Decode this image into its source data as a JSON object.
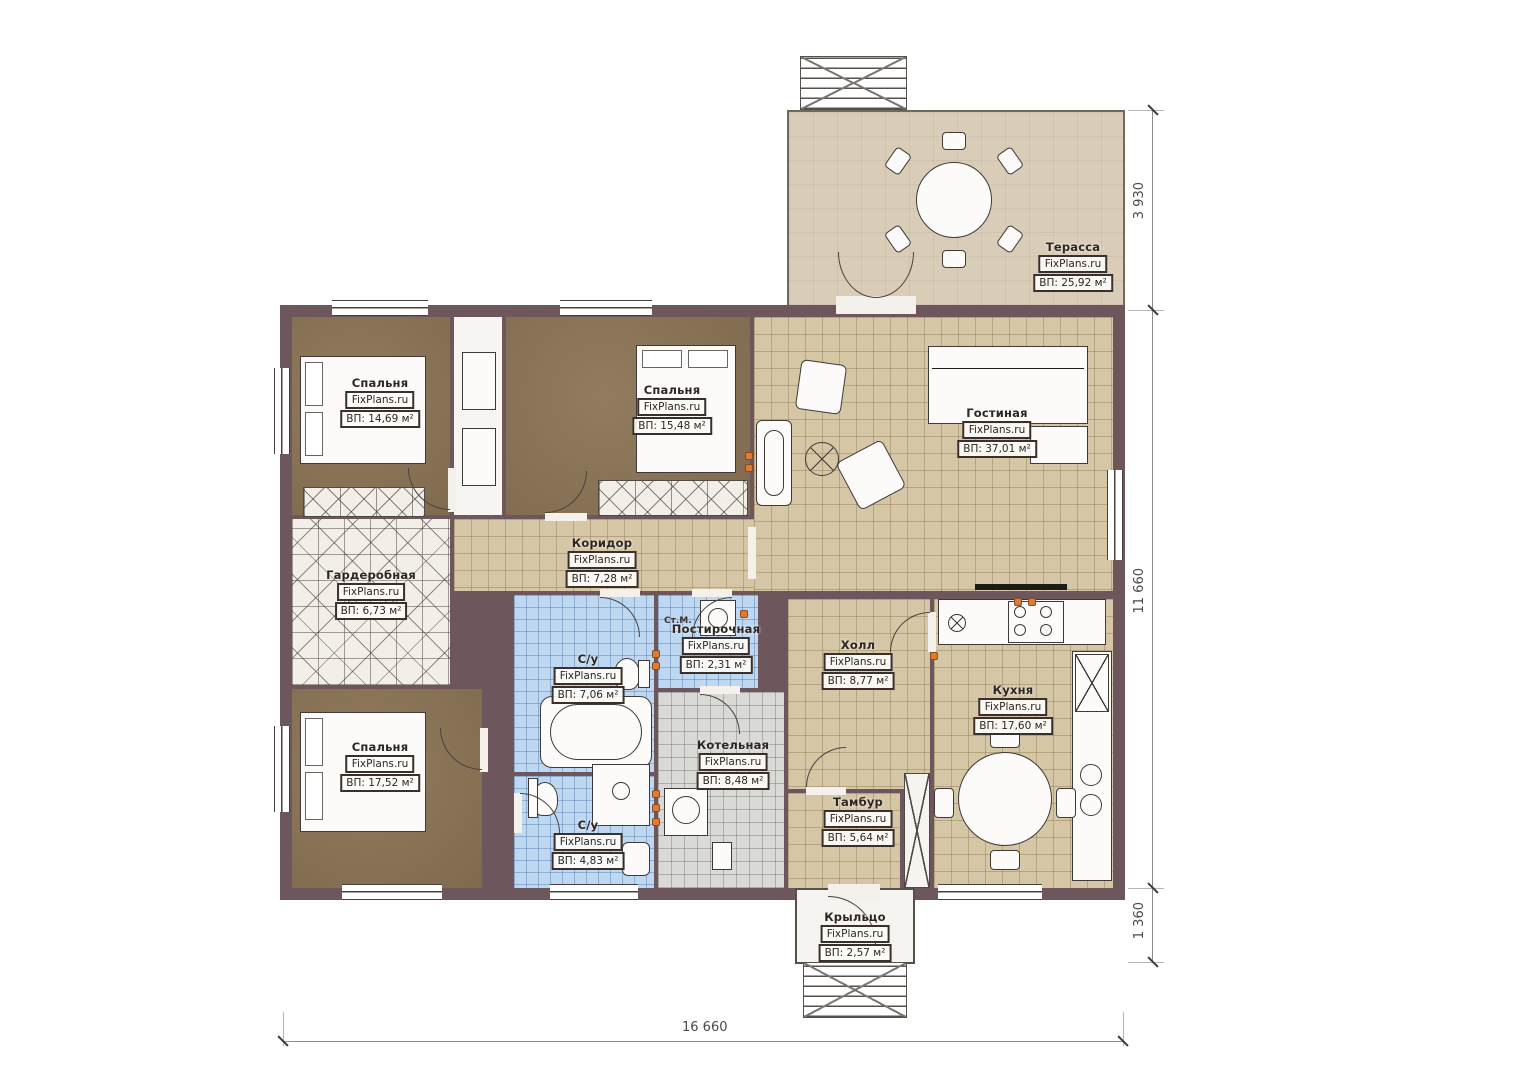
{
  "watermark": "FixPlans.ru",
  "rooms": [
    {
      "name": "Терасса",
      "area": "ВП: 25,92 м²"
    },
    {
      "name": "Спальня",
      "area": "ВП: 14,69 м²"
    },
    {
      "name": "Спальня",
      "area": "ВП: 15,48 м²"
    },
    {
      "name": "Гостиная",
      "area": "ВП: 37,01 м²"
    },
    {
      "name": "Коридор",
      "area": "ВП: 7,28 м²"
    },
    {
      "name": "Гардеробная",
      "area": "ВП: 6,73 м²"
    },
    {
      "name": "С/у",
      "area": "ВП: 7,06 м²"
    },
    {
      "name": "Постирочная",
      "area": "ВП: 2,31 м²"
    },
    {
      "name": "Холл",
      "area": "ВП: 8,77 м²"
    },
    {
      "name": "Котельная",
      "area": "ВП: 8,48 м²"
    },
    {
      "name": "Кухня",
      "area": "ВП: 17,60 м²"
    },
    {
      "name": "Тамбур",
      "area": "ВП: 5,64 м²"
    },
    {
      "name": "Спальня",
      "area": "ВП: 17,52 м²"
    },
    {
      "name": "С/у",
      "area": "ВП: 4,83 м²"
    },
    {
      "name": "Крыльцо",
      "area": "ВП: 2,57 м²"
    }
  ],
  "dimensions": {
    "right_top": "3 930",
    "right_main": "11 660",
    "right_bottom": "1 360",
    "bottom": "16 660"
  },
  "annotations": {
    "washing_machine": "Ст.М."
  },
  "colors": {
    "wall": "#6d575d",
    "tile_beige": "#d5c6a5",
    "tile_blue": "#bed8f1",
    "tile_gray": "#d9d9d6",
    "carpet": "#8b7355",
    "terrace": "#d9cdb8",
    "accent": "#e07b35"
  }
}
